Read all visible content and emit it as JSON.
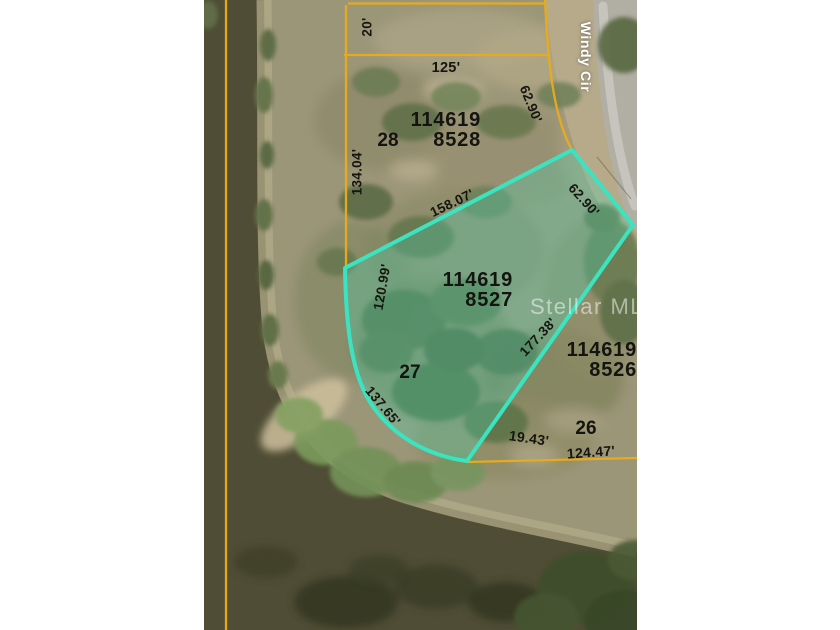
{
  "map": {
    "street": {
      "label": "Windy Cir"
    },
    "watermark": {
      "label": "Stellar MLS"
    },
    "parcels": {
      "p8528": {
        "id_top": "114619",
        "id_bottom": "8528",
        "lot": "28"
      },
      "p8527": {
        "id_top": "114619",
        "id_bottom": "8527",
        "lot": "27",
        "highlighted": true
      },
      "p8526": {
        "id_top": "114619",
        "id_bottom": "8526",
        "lot": "26"
      }
    },
    "dimensions": {
      "d20": {
        "label": "20'"
      },
      "d125": {
        "label": "125'"
      },
      "d6290a": {
        "label": "62.90'"
      },
      "d13404": {
        "label": "134.04'"
      },
      "d15807": {
        "label": "158.07'"
      },
      "d6290b": {
        "label": "62.90'"
      },
      "d12099": {
        "label": "120.99'"
      },
      "d17738": {
        "label": "177.38'"
      },
      "d13765": {
        "label": "137.65'"
      },
      "d1943": {
        "label": "19.43'"
      },
      "d12447": {
        "label": "124.47'"
      }
    },
    "colors": {
      "highlight_outline": "#3be4c1",
      "highlight_fill": "rgba(72,214,182,0.30)",
      "parcel_line": "#ecac19",
      "water": "#4f4d35",
      "road": "#b1aea4",
      "label_text": "#141410",
      "street_text": "#ffffff",
      "margin": "#ffffff"
    }
  }
}
